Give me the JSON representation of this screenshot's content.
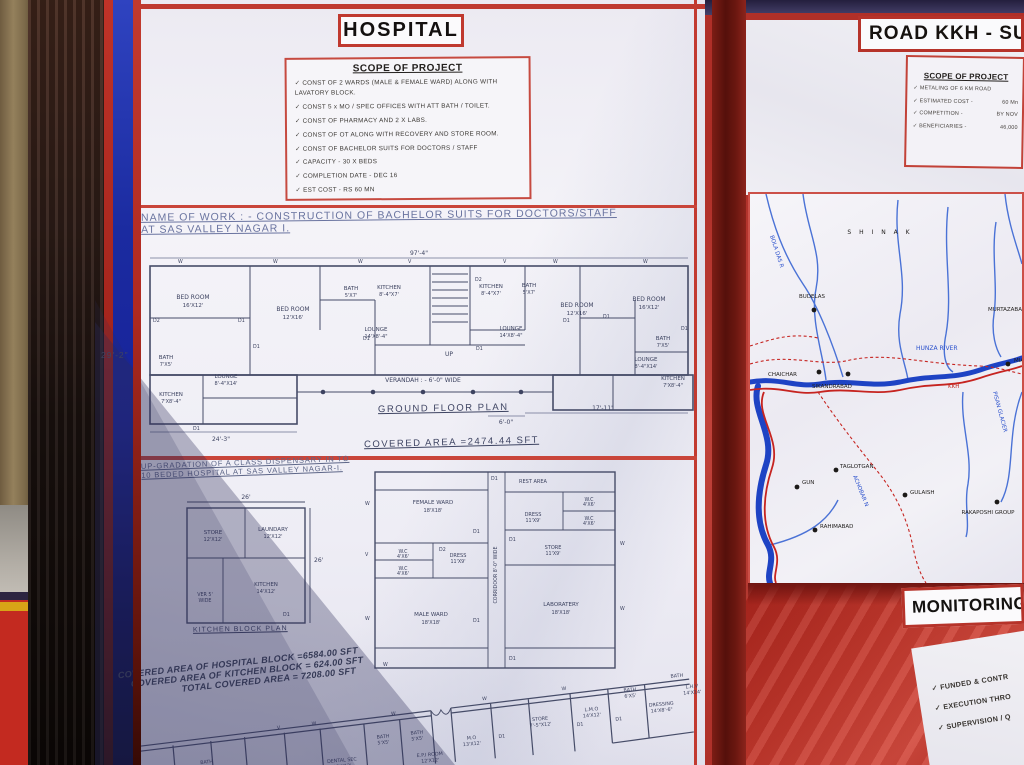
{
  "hospital": {
    "title": "HOSPITAL",
    "scope": {
      "title": "SCOPE OF PROJECT",
      "items": [
        "CONST OF 2 WARDS (MALE & FEMALE WARD) ALONG WITH LAVATORY BLOCK.",
        "CONST 5 x MO / SPEC OFFICES WITH ATT BATH / TOILET.",
        "CONST OF PHARMACY AND 2 X LABS.",
        "CONST OF OT ALONG WITH RECOVERY AND STORE ROOM.",
        "CONST OF BACHELOR SUITS FOR DOCTORS / STAFF",
        "CAPACITY - 30 X BEDS",
        "COMPLETION DATE - DEC 16",
        "EST COST - RS 60 MN"
      ]
    },
    "name_of_work": {
      "line1": "NAME OF WORK : -  CONSTRUCTION OF BACHELOR SUITS FOR DOCTORS/STAFF",
      "line2": "AT SAS VALLEY NAGAR I."
    },
    "ground_plan": {
      "caption": "GROUND FLOOR PLAN",
      "covered_area": "COVERED AREA =2474.44 SFT",
      "verandah": "VERANDAH : - 6'-0\" WIDE",
      "dims": {
        "top": "97'-4\"",
        "left": "29'-2\"",
        "bottom_left": "24'-3\"",
        "bottom_mid": "6'-0\"",
        "bottom_right": "17'-11\"",
        "up": "UP"
      },
      "rooms": [
        {
          "name": "BED ROOM",
          "size": "16'X12'"
        },
        {
          "name": "BATH",
          "size": "7'X5'"
        },
        {
          "name": "KITCHEN",
          "size": "7'X8'-4\""
        },
        {
          "name": "LOUNGE",
          "size": "8'-4\"X14'"
        },
        {
          "name": "BED ROOM",
          "size": "12'X16'"
        },
        {
          "name": "BATH",
          "size": "5'X7'"
        },
        {
          "name": "KITCHEN",
          "size": "8'-4\"X7'"
        },
        {
          "name": "LOUNGE",
          "size": "14'X8'-4\""
        },
        {
          "name": "KITCHEN",
          "size": "8'-4\"X7'"
        },
        {
          "name": "BATH",
          "size": "5'X7'"
        },
        {
          "name": "BED ROOM",
          "size": "12'X16'"
        },
        {
          "name": "LOUNGE",
          "size": "14'X8'-4\""
        },
        {
          "name": "BED ROOM",
          "size": "16'X12'"
        },
        {
          "name": "BATH",
          "size": "7'X5'"
        },
        {
          "name": "LOUNGE",
          "size": "8'-4\"X14'"
        },
        {
          "name": "KITCHEN",
          "size": "7'X8'-4\""
        }
      ]
    },
    "upgradation": {
      "line1": "UP-GRADATION OF A CLASS DISPENSARY IN TO",
      "line2": "10 BEDED HOSPITAL AT SAS VALLEY NAGAR-I."
    },
    "kitchen_block": {
      "caption": "KITCHEN BLOCK PLAN",
      "dim_top": "26'",
      "dim_right": "26'",
      "rooms": [
        {
          "name": "STORE",
          "size": "12'X12'"
        },
        {
          "name": "LAUNDARY",
          "size": "12'X12'"
        },
        {
          "name": "KITCHEN",
          "size": "14'X12'"
        },
        {
          "name": "VER 5'",
          "size": "WIDE"
        }
      ]
    },
    "hospital_block": {
      "corridor": "CORRIDOOR 8'-0\" WIDE",
      "rooms": [
        {
          "name": "REST AREA",
          "size": ""
        },
        {
          "name": "FEMALE WARD",
          "size": "18'X18'"
        },
        {
          "name": "W.C",
          "size": "4'X6'"
        },
        {
          "name": "W.C",
          "size": "4'X6'"
        },
        {
          "name": "DRESS",
          "size": "11'X9'"
        },
        {
          "name": "MALE WARD",
          "size": "18'X18'"
        },
        {
          "name": "DRESS",
          "size": "11'X9'"
        },
        {
          "name": "W.C",
          "size": "4'X6'"
        },
        {
          "name": "W.C",
          "size": "4'X6'"
        },
        {
          "name": "STORE",
          "size": "11'X9'"
        },
        {
          "name": "LABORATERY",
          "size": "18'X18'"
        }
      ]
    },
    "covered_areas": {
      "line1": "COVERED AREA OF HOSPITAL BLOCK =6584.00 SFT",
      "line2": "COVERED AREA OF KITCHEN BLOCK = 624.00 SFT",
      "line3": "TOTAL COVERED AREA  = 7208.00 SFT"
    },
    "bottom_plan": {
      "rooms": [
        {
          "name": "BATH",
          "size": "4'X6'"
        },
        {
          "name": "DENTAL",
          "size": ""
        },
        {
          "name": "DENTAL SEC",
          "size": "12'X12'"
        },
        {
          "name": "BATH",
          "size": "5'X5'"
        },
        {
          "name": "BATH",
          "size": "5'X5'"
        },
        {
          "name": "E.P.I ROOM",
          "size": "12'X12'"
        },
        {
          "name": "M.O",
          "size": "13'X12'"
        },
        {
          "name": "STORE",
          "size": "7'-5\"X12'"
        },
        {
          "name": "L.M.O",
          "size": "14'X12'"
        },
        {
          "name": "BATH",
          "size": "6'X5'"
        },
        {
          "name": "DRESSING",
          "size": "14'X8'-6\""
        },
        {
          "name": "BATH",
          "size": "5'-5\"X7'"
        },
        {
          "name": "L.H.V",
          "size": "14'X14'"
        }
      ]
    },
    "markers": {
      "d1": "D1",
      "d2": "D2",
      "w": "W",
      "v": "V"
    }
  },
  "road": {
    "title": "ROAD KKH - SU",
    "scope": {
      "title": "SCOPE OF PROJECT",
      "items": [
        {
          "label": "METALING OF 6 KM ROAD",
          "value": ""
        },
        {
          "label": "ESTIMATED COST  -",
          "value": "60 Mn"
        },
        {
          "label": "COMPETITION  -",
          "value": "BY NOV"
        },
        {
          "label": "BENEFICIARIES  -",
          "value": "46,000"
        }
      ]
    }
  },
  "map": {
    "region": "S H I N A K",
    "river_main": "HUNZA RIVER",
    "river_side": "BOLA DAS R",
    "river_achobar": "ACHOBAR N",
    "glacier": "PISAN GLACIER",
    "road": "KKH",
    "towns": [
      "BUDELAS",
      "MURTAZABAD",
      "CHAICHAR",
      "SIKANDRABAD",
      "MIA",
      "GUN",
      "TAGLOTGAN",
      "GULAISH",
      "RAKAPOSHI GROUP",
      "RAHIMABAD"
    ]
  },
  "monitoring": {
    "title": "MONITORING",
    "items": [
      "FUNDED & CONTR",
      "EXECUTION THRO",
      "SUPERVISION / Q"
    ]
  }
}
